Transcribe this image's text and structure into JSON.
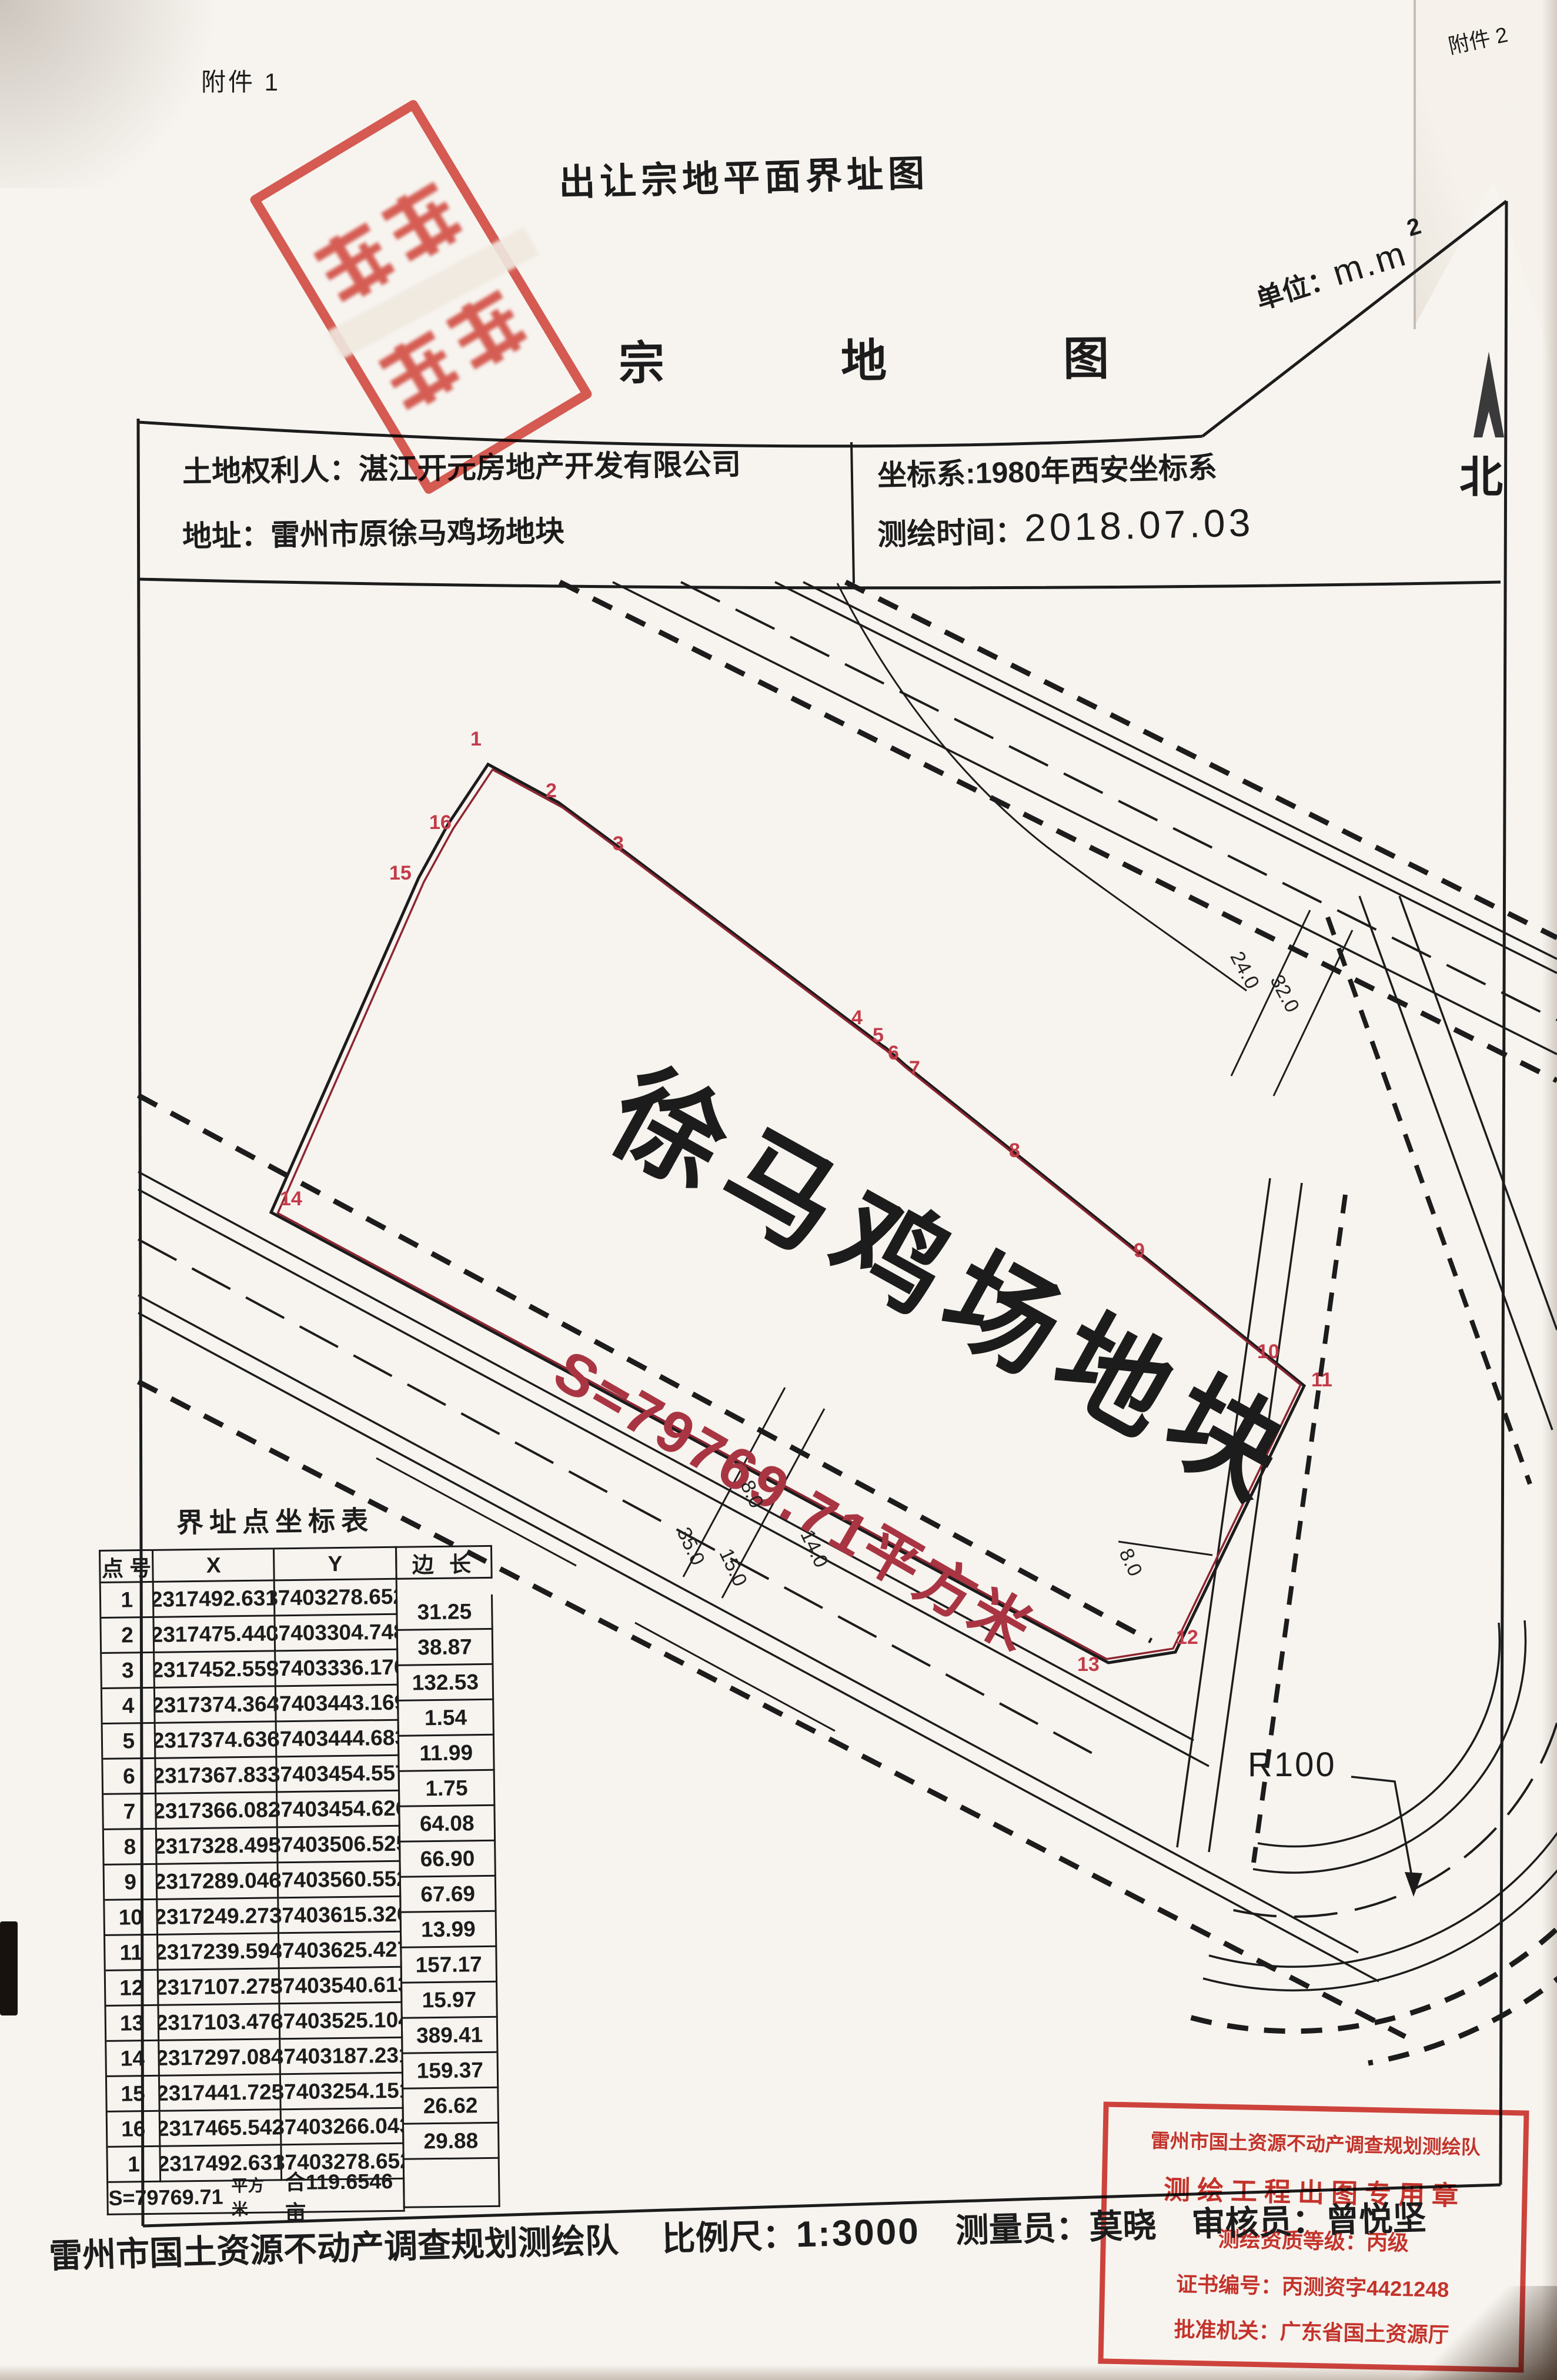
{
  "page": {
    "attachment_top": "附件 1",
    "attachment_corner": "附件 2",
    "title": "出让宗地平面界址图",
    "map_title_chars": [
      "宗",
      "地",
      "图"
    ],
    "unit_label": "单位：",
    "unit_value": "m.m",
    "unit_sup": "2",
    "north_label": "北"
  },
  "header": {
    "owner_label": "土地权利人：",
    "owner": "湛江开元房地产开发有限公司",
    "address_label": "地址：",
    "address": "雷州市原徐马鸡场地块",
    "crs_label": "坐标系:",
    "crs": "1980年西安坐标系",
    "date_label": "测绘时间：",
    "date": "2018.07.03"
  },
  "map": {
    "parcel_name": "徐马鸡场地块",
    "area_text": "S=79769.71平方米",
    "r100": "R100",
    "vertices": [
      "1",
      "2",
      "3",
      "4",
      "5",
      "6",
      "7",
      "8",
      "9",
      "10",
      "11",
      "12",
      "13",
      "14",
      "15",
      "16"
    ],
    "dims": {
      "d24": "24.0",
      "d32": "32.0",
      "d8a": "8.0",
      "d35": "35.0",
      "d15": "15.0",
      "d14": "14.0",
      "d8b": "8.0"
    }
  },
  "table": {
    "title": "界址点坐标表",
    "headers": {
      "pt": "点 号",
      "x": "X",
      "y": "Y",
      "len": "边 长"
    },
    "rows": [
      {
        "pt": "1",
        "x": "2317492.631",
        "y": "37403278.652"
      },
      {
        "pt": "2",
        "x": "2317475.440",
        "y": "37403304.748"
      },
      {
        "pt": "3",
        "x": "2317452.559",
        "y": "37403336.170"
      },
      {
        "pt": "4",
        "x": "2317374.364",
        "y": "37403443.169"
      },
      {
        "pt": "5",
        "x": "2317374.636",
        "y": "37403444.683"
      },
      {
        "pt": "6",
        "x": "2317367.833",
        "y": "37403454.557"
      },
      {
        "pt": "7",
        "x": "2317366.082",
        "y": "37403454.626"
      },
      {
        "pt": "8",
        "x": "2317328.495",
        "y": "37403506.525"
      },
      {
        "pt": "9",
        "x": "2317289.046",
        "y": "37403560.552"
      },
      {
        "pt": "10",
        "x": "2317249.273",
        "y": "37403615.326"
      },
      {
        "pt": "11",
        "x": "2317239.594",
        "y": "37403625.427"
      },
      {
        "pt": "12",
        "x": "2317107.275",
        "y": "37403540.613"
      },
      {
        "pt": "13",
        "x": "2317103.476",
        "y": "37403525.104"
      },
      {
        "pt": "14",
        "x": "2317297.084",
        "y": "37403187.231"
      },
      {
        "pt": "15",
        "x": "2317441.725",
        "y": "37403254.151"
      },
      {
        "pt": "16",
        "x": "2317465.542",
        "y": "37403266.043"
      },
      {
        "pt": "1",
        "x": "2317492.631",
        "y": "37403278.652"
      }
    ],
    "edges": [
      "31.25",
      "38.87",
      "132.53",
      "1.54",
      "11.99",
      "1.75",
      "64.08",
      "66.90",
      "67.69",
      "13.99",
      "157.17",
      "15.97",
      "389.41",
      "159.37",
      "26.62",
      "29.88"
    ],
    "footer_s": "S=79769.71",
    "footer_unit": "平方米",
    "footer_mu": "合119.6546亩"
  },
  "footer": {
    "agency": "雷州市国土资源不动产调查规划测绘队",
    "scale_label": "比例尺：",
    "scale": "1:3000",
    "surveyor_label": "测量员：",
    "surveyor": "莫晓",
    "reviewer_label": "审核员：",
    "reviewer": "曾悦坚"
  },
  "stamp_bottom": {
    "line1": "雷州市国土资源不动产调查规划测绘队",
    "line2": "测绘工程出图专用章",
    "line3": "测绘资质等级：丙级",
    "line4": "证书编号：丙测资字4421248",
    "line5": "批准机关：广东省国土资源厅"
  },
  "stamp_top": {
    "shape": "rectangular",
    "color": "#d6463c",
    "text_legible": false
  },
  "colors": {
    "ink": "#1c1c1c",
    "boundary_red": "#8e2532",
    "area_red": "#a93543",
    "vertex_red": "#c23b49",
    "seal_red": "#cc261e"
  }
}
